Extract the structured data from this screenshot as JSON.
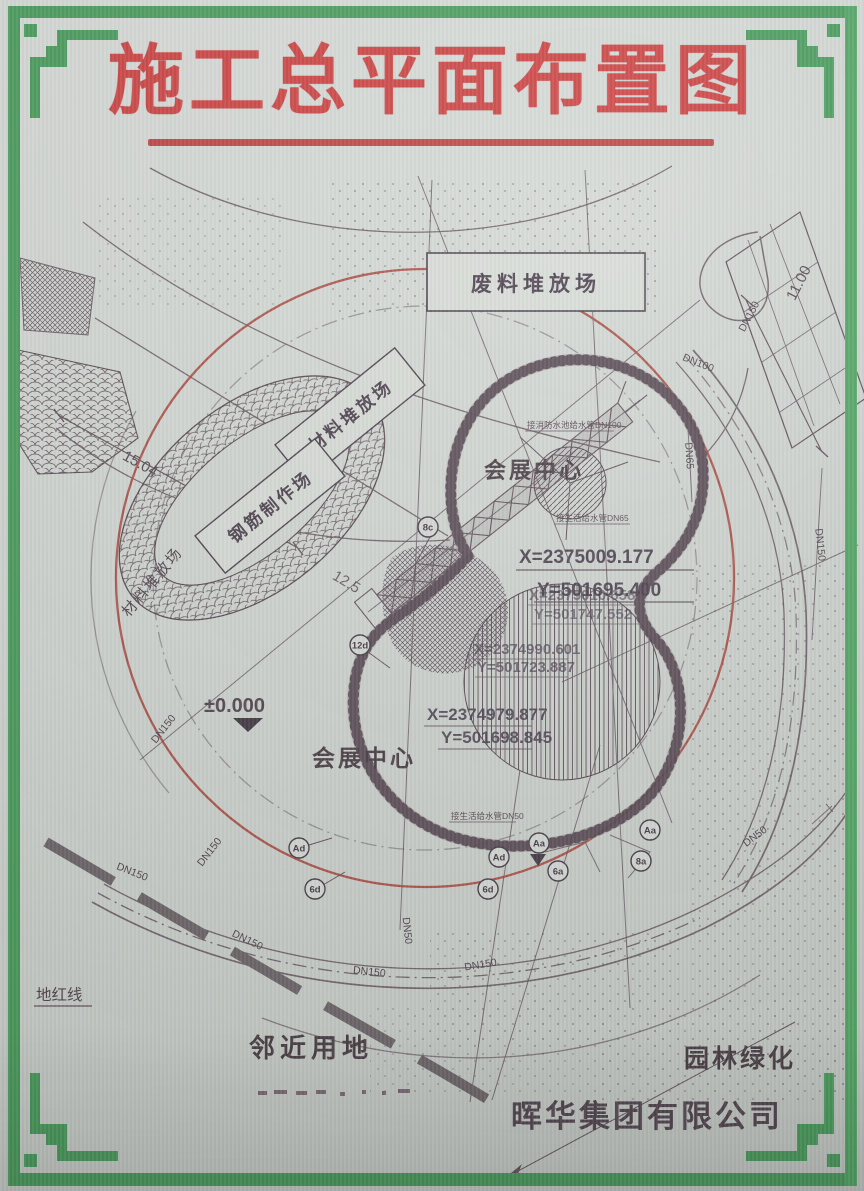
{
  "title": "施工总平面布置图",
  "company": "晖华集团有限公司",
  "labels": {
    "waste_yard": "废料堆放场",
    "material_yard_box": "材料堆放场",
    "rebar_yard_box": "钢筋制作场",
    "material_yard_left": "材料堆放场",
    "exhibition_center_top": "会展中心",
    "exhibition_center_bottom": "会展中心",
    "adjacent_land": "邻近用地",
    "landscaping": "园林绿化",
    "land_red_line": "地红线",
    "elevation_zero": "±0.000"
  },
  "dimensions": {
    "left": "15.04",
    "strip": "11.00",
    "mid": "12.5"
  },
  "coordinates": [
    {
      "x": "X=2375009.177",
      "y": "Y=501695.400"
    },
    {
      "x": "X=2375010.658",
      "y": "Y=501747.552"
    },
    {
      "x": "X=2374990.601",
      "y": "Y=501723.887"
    },
    {
      "x": "X=2374979.877",
      "y": "Y=501698.845"
    }
  ],
  "pipe_notes": {
    "fire": "接消防水池给水管DN100",
    "domestic65": "接生活给水管DN65",
    "domestic50": "接生活给水管DN50"
  },
  "dn_labels": [
    "DN150",
    "DN100",
    "DN65",
    "DN150",
    "DN50",
    "DN150",
    "DN150",
    "DN150",
    "DN150",
    "DN50",
    "DN150",
    "DN150"
  ],
  "markers": [
    "8c",
    "12d",
    "Ad",
    "6d",
    "Ad",
    "6d",
    "Aa",
    "6a",
    "Aa",
    "8a"
  ],
  "colors": {
    "frame_green": "#4d9e60",
    "title_red": "#ce4545",
    "plan_red": "#a8493f",
    "line": "#655560",
    "paper": "#ced3cf"
  }
}
